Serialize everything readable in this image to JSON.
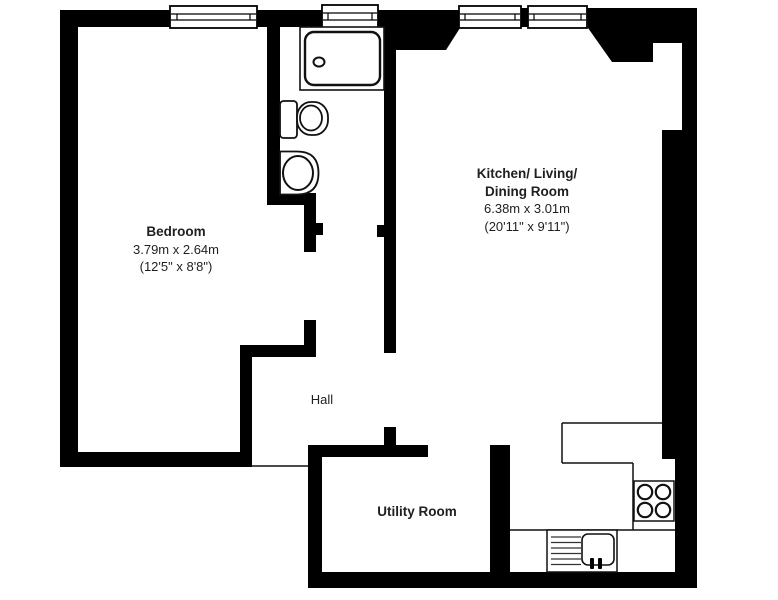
{
  "title": "Flat floor plan",
  "colors": {
    "wall": "#000000",
    "background": "#ffffff",
    "fixture_stroke": "#111111",
    "text": "#1f1f1f"
  },
  "rooms": {
    "bedroom": {
      "name": "Bedroom",
      "dim_metric": "3.79m x 2.64m",
      "dim_imperial": "(12'5\" x 8'8\")"
    },
    "kitchen_living_dining": {
      "name_line1": "Kitchen/ Living/",
      "name_line2": "Dining Room",
      "dim_metric": "6.38m x 3.01m",
      "dim_imperial": "(20'11\" x 9'11\")"
    },
    "hall": {
      "name": "Hall"
    },
    "utility": {
      "name": "Utility Room"
    }
  },
  "fixtures": {
    "bathroom": [
      "shower-tray",
      "toilet",
      "wash-basin"
    ],
    "kitchen": [
      "worktop",
      "hob",
      "sink-with-drainer"
    ],
    "windows": [
      "bedroom-window",
      "bathroom-window",
      "kitchen-window-1",
      "kitchen-window-2"
    ]
  }
}
